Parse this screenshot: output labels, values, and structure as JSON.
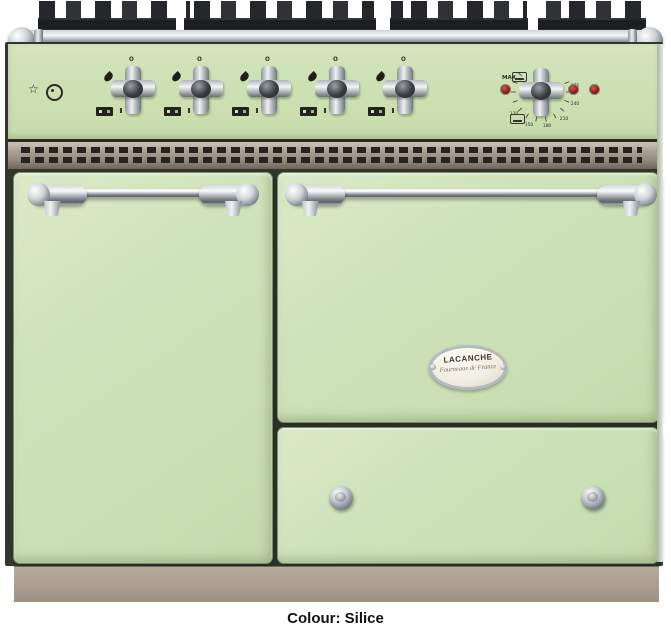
{
  "caption": "Colour: Silice",
  "badge": {
    "brand": "LACANCHE",
    "tagline": "Fourneaux de France"
  },
  "controls": {
    "off_marker": "o",
    "burner_count": 5,
    "indicator_light_count": 3,
    "thermostat": {
      "max_label": "MAX",
      "scale": [
        "120",
        "150",
        "180",
        "210",
        "240",
        "275"
      ]
    }
  },
  "colors": {
    "body_enamel_silice": "#cfe2b6",
    "chrome_trim": "#c9ced2",
    "vent_plinth_taupe": "#a99e90",
    "grate_cast_iron": "#26272b",
    "indicator_light_red": "#8c1d12",
    "caption_text": "#111111"
  }
}
